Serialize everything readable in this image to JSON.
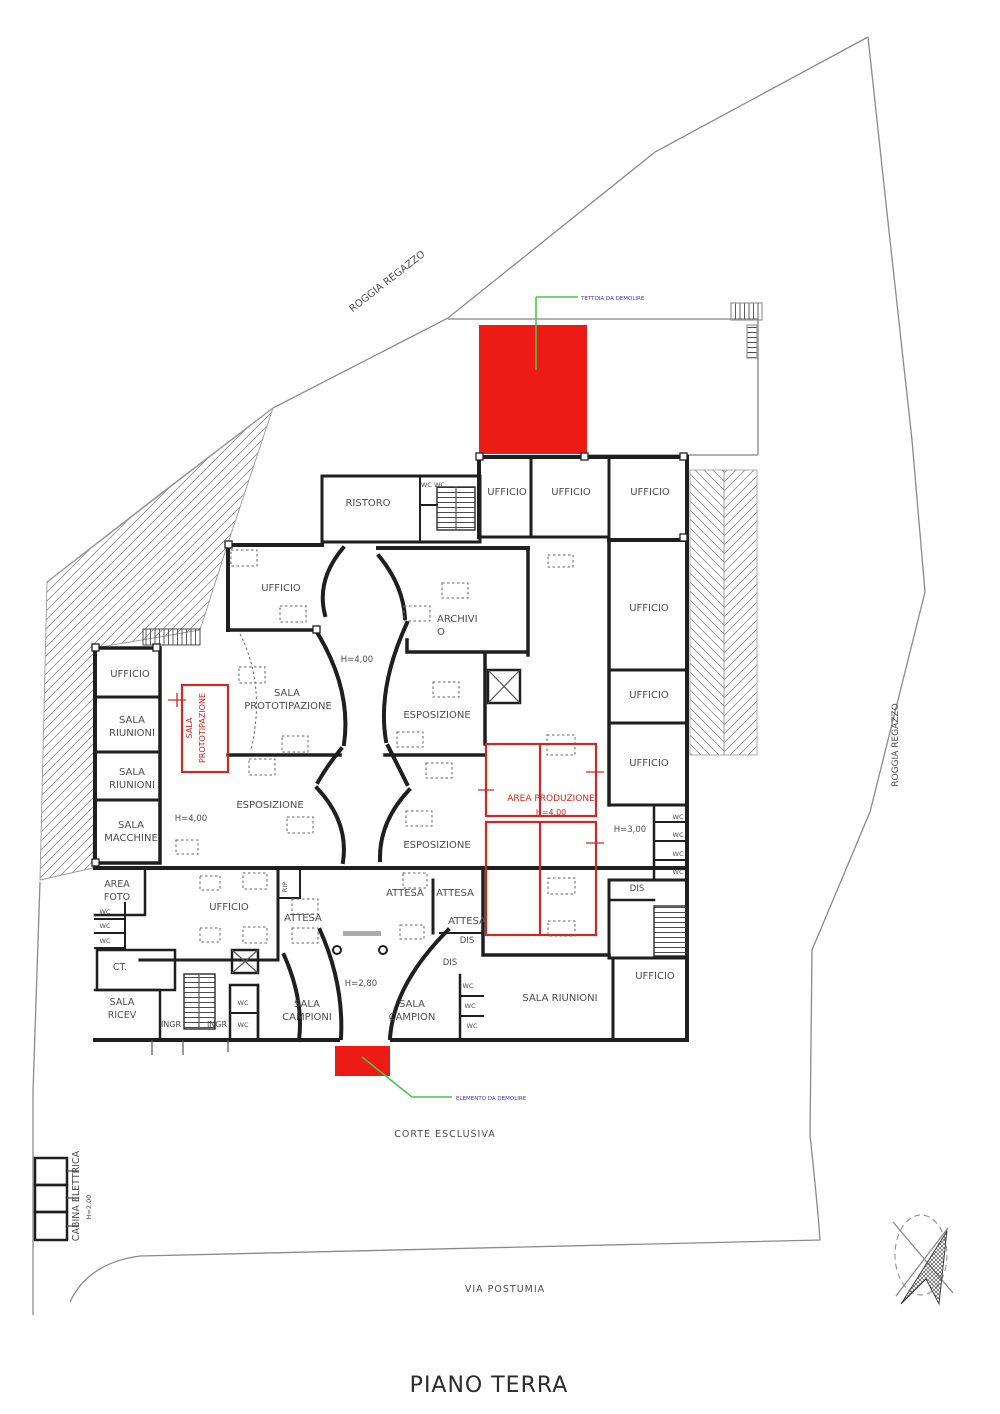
{
  "colors": {
    "red": "#ec1b15",
    "red_line": "#cb2a24",
    "green": "#46c846",
    "blue": "#3a35c8",
    "wall": "#1f1f1f",
    "gray": "#979797",
    "label": "#4d4d4d",
    "title": "#2b2b2b"
  },
  "annotations": {
    "tettoia": "TETTOIA DA DEMOLIRE",
    "elemento": "ELEMENTO DA DEMOLIRE"
  },
  "labels": [
    {
      "t": "ROGGIA REGAZZO",
      "x": 389,
      "y": 284,
      "s": 10,
      "r": -38
    },
    {
      "t": "ROGGIA REGAZZO",
      "x": 898,
      "y": 745,
      "s": 9,
      "r": -90
    },
    {
      "t": "CORTE ESCLUSIVA",
      "x": 445,
      "y": 1137,
      "s": 9.5,
      "w": 1
    },
    {
      "t": "VIA POSTUMIA",
      "x": 505,
      "y": 1292,
      "s": 9.5,
      "w": 1
    },
    {
      "t": "CABINA ELETTRICA",
      "x": 79,
      "y": 1196,
      "s": 9.5,
      "r": -90
    },
    {
      "t": "H=2,00",
      "x": 91,
      "y": 1207,
      "s": 6.5,
      "r": -90
    },
    {
      "t": "PIANO TERRA",
      "x": 489,
      "y": 1392,
      "s": 22,
      "w": 1,
      "c": "title"
    },
    {
      "t": "TETTOIA DA DEMOLIRE",
      "x": 581,
      "y": 300,
      "s": 5.5,
      "c": "blue",
      "a": "start"
    },
    {
      "t": "ELEMENTO DA DEMOLIRE",
      "x": 456,
      "y": 1100,
      "s": 5.5,
      "c": "blue",
      "a": "start"
    },
    {
      "t": "RISTORO",
      "x": 368,
      "y": 506,
      "s": 10
    },
    {
      "t": "WC WC",
      "x": 433,
      "y": 487,
      "s": 6.5
    },
    {
      "t": "UFFICIO",
      "x": 507,
      "y": 495,
      "s": 10
    },
    {
      "t": "UFFICIO",
      "x": 571,
      "y": 495,
      "s": 10
    },
    {
      "t": "UFFICIO",
      "x": 650,
      "y": 495,
      "s": 10
    },
    {
      "t": "UFFICIO",
      "x": 281,
      "y": 591,
      "s": 10
    },
    {
      "t": "ARCHIVI",
      "x": 437,
      "y": 622,
      "s": 10,
      "a": "start"
    },
    {
      "t": "O",
      "x": 437,
      "y": 635,
      "s": 10,
      "a": "start"
    },
    {
      "t": "H=4,00",
      "x": 357,
      "y": 662,
      "s": 8.5
    },
    {
      "t": "UFFICIO",
      "x": 649,
      "y": 611,
      "s": 10
    },
    {
      "t": "UFFICIO",
      "x": 649,
      "y": 698,
      "s": 10
    },
    {
      "t": "UFFICIO",
      "x": 649,
      "y": 766,
      "s": 10
    },
    {
      "t": "UFFICIO",
      "x": 130,
      "y": 677,
      "s": 10
    },
    {
      "t": "SALA",
      "x": 132,
      "y": 723,
      "s": 10
    },
    {
      "t": "RIUNIONI",
      "x": 132,
      "y": 736,
      "s": 10
    },
    {
      "t": "SALA",
      "x": 132,
      "y": 775,
      "s": 10
    },
    {
      "t": "RIUNIONI",
      "x": 132,
      "y": 788,
      "s": 10
    },
    {
      "t": "SALA",
      "x": 131,
      "y": 828,
      "s": 10
    },
    {
      "t": "MACCHINE",
      "x": 131,
      "y": 841,
      "s": 10
    },
    {
      "t": "SALA",
      "x": 192,
      "y": 728,
      "s": 8,
      "r": -90,
      "c": "red_line"
    },
    {
      "t": "PROTOTIPAZIONE",
      "x": 205,
      "y": 728,
      "s": 8,
      "r": -90,
      "c": "red_line"
    },
    {
      "t": "SALA",
      "x": 287,
      "y": 696,
      "s": 10
    },
    {
      "t": "PROTOTIPAZIONE",
      "x": 288,
      "y": 709,
      "s": 10
    },
    {
      "t": "ESPOSIZIONE",
      "x": 437,
      "y": 718,
      "s": 10
    },
    {
      "t": "ESPOSIZIONE",
      "x": 270,
      "y": 808,
      "s": 10
    },
    {
      "t": "H=4,00",
      "x": 191,
      "y": 821,
      "s": 8.5
    },
    {
      "t": "ESPOSIZIONE",
      "x": 437,
      "y": 848,
      "s": 10
    },
    {
      "t": "AREA PRODUZIONE",
      "x": 551,
      "y": 801,
      "s": 9,
      "c": "red_line"
    },
    {
      "t": "H=4,00",
      "x": 551,
      "y": 815,
      "s": 8,
      "c": "red_line"
    },
    {
      "t": "H=3,00",
      "x": 630,
      "y": 832,
      "s": 8.5
    },
    {
      "t": "WC",
      "x": 678,
      "y": 819,
      "s": 6.5
    },
    {
      "t": "WC",
      "x": 678,
      "y": 837,
      "s": 6.5
    },
    {
      "t": "WC",
      "x": 678,
      "y": 856,
      "s": 6.5
    },
    {
      "t": "WC",
      "x": 678,
      "y": 874,
      "s": 6.5
    },
    {
      "t": "DIS",
      "x": 637,
      "y": 891,
      "s": 8.5
    },
    {
      "t": "AREA",
      "x": 117,
      "y": 887,
      "s": 9.5
    },
    {
      "t": "FOTO",
      "x": 117,
      "y": 900,
      "s": 9.5
    },
    {
      "t": "RIP",
      "x": 287,
      "y": 887,
      "s": 6.5,
      "r": -90
    },
    {
      "t": "UFFICIO",
      "x": 229,
      "y": 910,
      "s": 10
    },
    {
      "t": "ATTESA",
      "x": 405,
      "y": 896,
      "s": 10
    },
    {
      "t": "ATTESA",
      "x": 455,
      "y": 896,
      "s": 10
    },
    {
      "t": "ATTESA",
      "x": 303,
      "y": 921,
      "s": 10
    },
    {
      "t": "ATTESA",
      "x": 467,
      "y": 924,
      "s": 10
    },
    {
      "t": "DIS",
      "x": 467,
      "y": 943,
      "s": 8.5
    },
    {
      "t": "DIS",
      "x": 450,
      "y": 965,
      "s": 8.5
    },
    {
      "t": "H=2,80",
      "x": 361,
      "y": 986,
      "s": 8.5
    },
    {
      "t": "CT.",
      "x": 120,
      "y": 970,
      "s": 9.5
    },
    {
      "t": "WC",
      "x": 105,
      "y": 914,
      "s": 6.5
    },
    {
      "t": "WC",
      "x": 105,
      "y": 928,
      "s": 6.5
    },
    {
      "t": "WC",
      "x": 105,
      "y": 943,
      "s": 6.5
    },
    {
      "t": "SALA",
      "x": 122,
      "y": 1005,
      "s": 9.5
    },
    {
      "t": "RICEV",
      "x": 122,
      "y": 1018,
      "s": 9.5
    },
    {
      "t": "INGR",
      "x": 171,
      "y": 1027,
      "s": 8
    },
    {
      "t": "INGR",
      "x": 217,
      "y": 1027,
      "s": 8
    },
    {
      "t": "WC",
      "x": 243,
      "y": 1005,
      "s": 6.5
    },
    {
      "t": "WC",
      "x": 243,
      "y": 1027,
      "s": 6.5
    },
    {
      "t": "SALA",
      "x": 307,
      "y": 1007,
      "s": 10
    },
    {
      "t": "CAMPIONI",
      "x": 307,
      "y": 1020,
      "s": 10
    },
    {
      "t": "SALA",
      "x": 412,
      "y": 1007,
      "s": 10
    },
    {
      "t": "CAMPION",
      "x": 412,
      "y": 1020,
      "s": 10
    },
    {
      "t": "WC",
      "x": 468,
      "y": 988,
      "s": 6.5
    },
    {
      "t": "WC",
      "x": 470,
      "y": 1008,
      "s": 6.5
    },
    {
      "t": "WC",
      "x": 472,
      "y": 1028,
      "s": 6.5
    },
    {
      "t": "SALA RIUNIONI",
      "x": 560,
      "y": 1001,
      "s": 10
    },
    {
      "t": "UFFICIO",
      "x": 655,
      "y": 979,
      "s": 10
    }
  ]
}
